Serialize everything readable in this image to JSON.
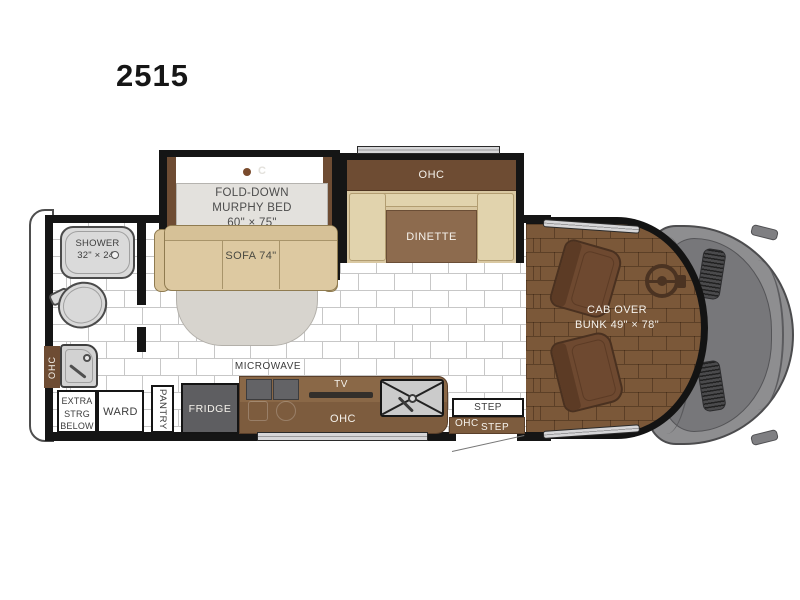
{
  "title": "2515",
  "labels": {
    "shower_name": "SHOWER",
    "shower_size": "32\" × 24\"",
    "bath_ohc": "OHC",
    "extra_l1": "EXTRA",
    "extra_l2": "STRG",
    "extra_l3": "BELOW",
    "ward": "WARD",
    "pantry": "PANTRY",
    "fridge": "FRIDGE",
    "microwave": "MICROWAVE",
    "tv": "TV",
    "kitchen_ohc": "OHC",
    "murphy_l1": "FOLD-DOWN",
    "murphy_l2": "MURPHY BED",
    "murphy_size": "60\" × 75\"",
    "murphy_light": "C",
    "sofa": "SOFA 74\"",
    "dinette_ohc": "OHC",
    "dinette": "DINETTE",
    "cab_l1": "CAB OVER",
    "cab_l2": "BUNK 49\" × 78\"",
    "step_upper": "STEP",
    "entry_ohc": "OHC",
    "step_lower": "STEP"
  },
  "colors": {
    "wall": "#151515",
    "cabinet_brown": "#6e4c33",
    "counter_brown": "#7d5c3e",
    "sofa_tan": "#ddc9a1",
    "bench_tan": "#e1d3ad",
    "table_brown": "#8d6b4e",
    "cab_floor_brown": "#7b5839",
    "chair_brown": "#6e4930",
    "front_cap_gray": "#8e8e90",
    "hood_gray": "#77777a",
    "fridge_gray": "#5e5e61",
    "fixture_gray": "#d8d8d8",
    "window_silver": "#d6d6d8",
    "bed_gray": "#e3e1dd",
    "footprint_gray": "#d7d4ce"
  }
}
